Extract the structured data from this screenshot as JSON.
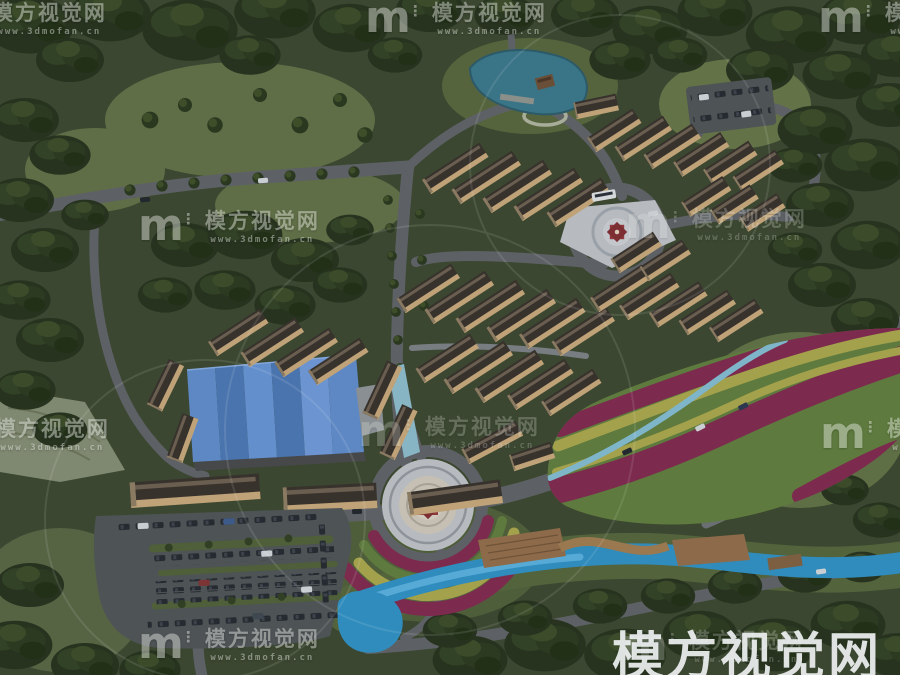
{
  "watermark": {
    "logo_glyph": "m",
    "logo_ticks": "⋮",
    "site_name": "模方视觉网",
    "site_url": "www.3dmofan.cn",
    "large_text": "模方视觉网"
  },
  "colors": {
    "base": "#3b4730",
    "forest_dark": "#27331f",
    "forest_mid": "#324226",
    "tree_light": "#42512b",
    "grass": "#4a5836",
    "grass_light": "#5f6e46",
    "road": "#5d6165",
    "road_light": "#9aa0a5",
    "pond": "#3a7487",
    "stream": "#2f8cbd",
    "roof": "#38322d",
    "wall": "#bfa277",
    "blue_roof": "#5d88c4",
    "blue_roof_dark": "#4a74ae",
    "plaza": "#b7bbc0",
    "star_red": "#8e3a3c",
    "flower_magenta": "#7c2b4e",
    "flower_yellow": "#a3a14b",
    "flower_green": "#5e7a3e",
    "deck": "#8d6b4a",
    "canal": "#88b5c4",
    "parking": "#4e5356",
    "watermark": "#eef1f2"
  }
}
